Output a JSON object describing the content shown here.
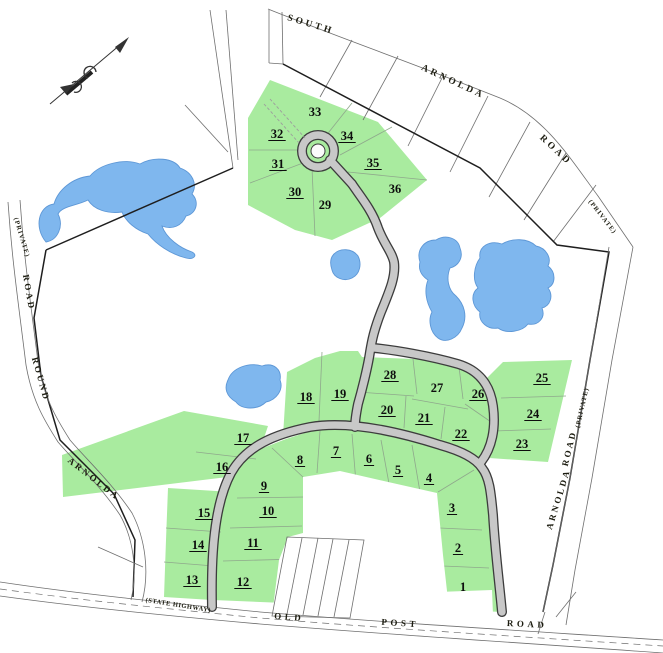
{
  "map": {
    "title": "subdivision-plat",
    "colors": {
      "lot_fill": "#a9eb9f",
      "pond_fill": "#7fb7ee",
      "pond_edge": "#5d97d6",
      "road_fill": "#c8c8c8",
      "road_casing": "#3c3c3c",
      "divider": "#8fa88c",
      "thin_line": "#6f6f6f",
      "boundary": "#1e1e1e",
      "number": "#0d0d0d",
      "label": "#1c1c10"
    },
    "lots": [
      {
        "n": "1",
        "x": 463,
        "y": 587,
        "u": false
      },
      {
        "n": "2",
        "x": 458,
        "y": 548,
        "u": true
      },
      {
        "n": "3",
        "x": 452,
        "y": 508,
        "u": true
      },
      {
        "n": "4",
        "x": 429,
        "y": 478,
        "u": true
      },
      {
        "n": "5",
        "x": 398,
        "y": 470,
        "u": true
      },
      {
        "n": "6",
        "x": 369,
        "y": 459,
        "u": true
      },
      {
        "n": "7",
        "x": 336,
        "y": 451,
        "u": true
      },
      {
        "n": "8",
        "x": 300,
        "y": 460,
        "u": true
      },
      {
        "n": "9",
        "x": 264,
        "y": 486,
        "u": true
      },
      {
        "n": "10",
        "x": 268,
        "y": 511,
        "u": true
      },
      {
        "n": "11",
        "x": 253,
        "y": 543,
        "u": true
      },
      {
        "n": "12",
        "x": 243,
        "y": 582,
        "u": true
      },
      {
        "n": "13",
        "x": 192,
        "y": 580,
        "u": true
      },
      {
        "n": "14",
        "x": 198,
        "y": 545,
        "u": true
      },
      {
        "n": "15",
        "x": 204,
        "y": 513,
        "u": true
      },
      {
        "n": "16",
        "x": 222,
        "y": 467,
        "u": true
      },
      {
        "n": "17",
        "x": 243,
        "y": 438,
        "u": true
      },
      {
        "n": "18",
        "x": 306,
        "y": 397,
        "u": true
      },
      {
        "n": "19",
        "x": 340,
        "y": 394,
        "u": true
      },
      {
        "n": "20",
        "x": 387,
        "y": 410,
        "u": true
      },
      {
        "n": "21",
        "x": 424,
        "y": 418,
        "u": true
      },
      {
        "n": "22",
        "x": 461,
        "y": 434,
        "u": true
      },
      {
        "n": "23",
        "x": 522,
        "y": 444,
        "u": true
      },
      {
        "n": "24",
        "x": 533,
        "y": 414,
        "u": true
      },
      {
        "n": "25",
        "x": 542,
        "y": 378,
        "u": true
      },
      {
        "n": "26",
        "x": 478,
        "y": 394,
        "u": true
      },
      {
        "n": "27",
        "x": 437,
        "y": 388,
        "u": false
      },
      {
        "n": "28",
        "x": 390,
        "y": 375,
        "u": true
      },
      {
        "n": "29",
        "x": 325,
        "y": 205,
        "u": false
      },
      {
        "n": "30",
        "x": 295,
        "y": 192,
        "u": true
      },
      {
        "n": "31",
        "x": 278,
        "y": 164,
        "u": true
      },
      {
        "n": "32",
        "x": 277,
        "y": 134,
        "u": true
      },
      {
        "n": "33",
        "x": 315,
        "y": 112,
        "u": false
      },
      {
        "n": "34",
        "x": 347,
        "y": 136,
        "u": true
      },
      {
        "n": "35",
        "x": 373,
        "y": 163,
        "u": true
      },
      {
        "n": "36",
        "x": 395,
        "y": 189,
        "u": false
      }
    ],
    "road_labels": [
      {
        "text": "SOUTH",
        "x": 310,
        "y": 27,
        "rot": 17,
        "size": 9.5,
        "ls": 3
      },
      {
        "text": "ARNOLDA",
        "x": 452,
        "y": 84,
        "rot": 25,
        "size": 9.5,
        "ls": 3
      },
      {
        "text": "ROAD",
        "x": 554,
        "y": 152,
        "rot": 43,
        "size": 9.5,
        "ls": 3
      },
      {
        "text": "(PRIVATE)",
        "x": 601,
        "y": 218,
        "rot": 52,
        "size": 6.5,
        "ls": 1
      },
      {
        "text": "(PRIVATE)",
        "x": 20,
        "y": 238,
        "rot": 73,
        "size": 6.5,
        "ls": 1
      },
      {
        "text": "ROAD",
        "x": 26,
        "y": 293,
        "rot": 80,
        "size": 9,
        "ls": 2.5
      },
      {
        "text": "ROUND",
        "x": 38,
        "y": 380,
        "rot": 74,
        "size": 9,
        "ls": 2.5
      },
      {
        "text": "ARNOLDA",
        "x": 92,
        "y": 481,
        "rot": 38,
        "size": 9,
        "ls": 2.5
      },
      {
        "text": "(PRIVATE)",
        "x": 584,
        "y": 408,
        "rot": -77,
        "size": 6.5,
        "ls": 1
      },
      {
        "text": "ROAD",
        "x": 572,
        "y": 449,
        "rot": -76,
        "size": 9,
        "ls": 2.5
      },
      {
        "text": "ARNOLDA",
        "x": 561,
        "y": 500,
        "rot": -73,
        "size": 9,
        "ls": 2.5
      },
      {
        "text": "(STATE HIGHWAY)",
        "x": 178,
        "y": 607,
        "rot": 9,
        "size": 6.5,
        "ls": 0.5
      },
      {
        "text": "OLD",
        "x": 289,
        "y": 620,
        "rot": 5,
        "size": 9,
        "ls": 3.5
      },
      {
        "text": "POST",
        "x": 400,
        "y": 626,
        "rot": 4,
        "size": 9,
        "ls": 3.5
      },
      {
        "text": "ROAD",
        "x": 527,
        "y": 627,
        "rot": 3,
        "size": 9,
        "ls": 3.5
      }
    ],
    "compass": {
      "icon": "north-arrow"
    }
  }
}
